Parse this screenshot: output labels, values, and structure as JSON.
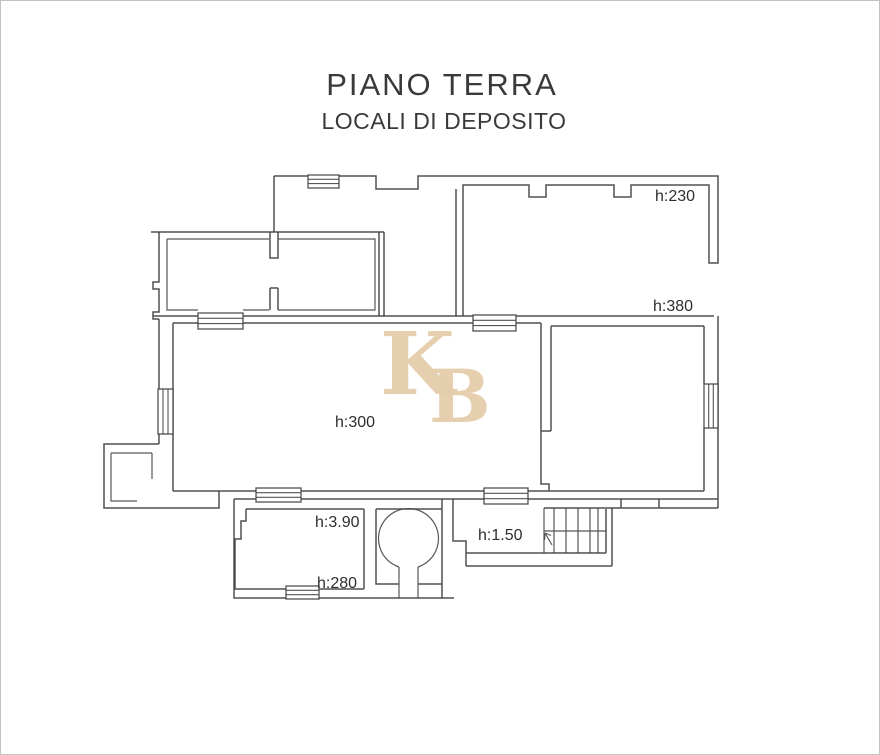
{
  "window_frame": {
    "border_color": "#c2c2c2",
    "background": "#ffffff"
  },
  "header": {
    "title": "PIANO TERRA",
    "subtitle": "LOCALI DI DEPOSITO"
  },
  "watermark": {
    "letters": [
      "K",
      "B"
    ],
    "color": "#e4cdaa"
  },
  "floor_plan": {
    "ink_color": "#424242",
    "room_height_labels": [
      {
        "text": "h:230"
      },
      {
        "text": "h:380"
      },
      {
        "text": "h:300"
      },
      {
        "text": "h:3.90"
      },
      {
        "text": "h:280"
      },
      {
        "text": "h:1.50"
      }
    ],
    "symbols": [
      "window",
      "staircase",
      "circular-tank",
      "direction-arrow"
    ]
  }
}
